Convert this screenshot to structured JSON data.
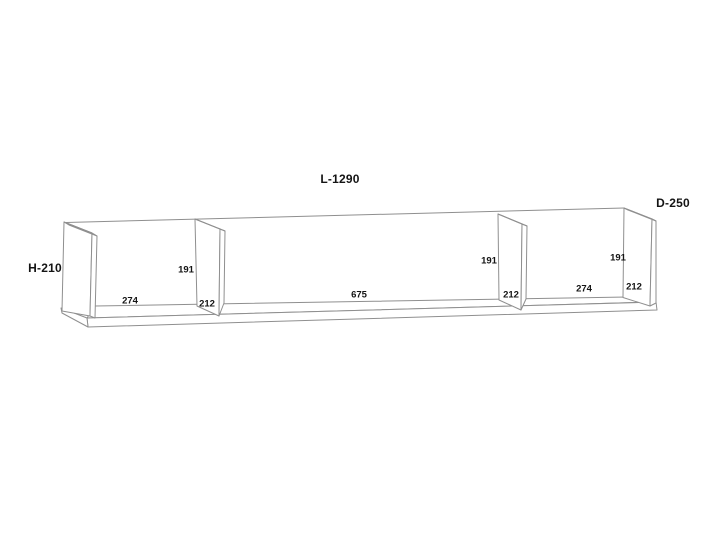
{
  "diagram": {
    "type": "furniture-dimension-drawing",
    "subject": "wall-shelf-3d-line-drawing",
    "background_color": "#ffffff",
    "line_color": "#8f8f8f",
    "text_color": "#141414",
    "overall": {
      "length_label": "L-1290",
      "depth_label": "D-250",
      "height_label": "H-210"
    },
    "sections": [
      {
        "name": "left-compartment",
        "width": "274",
        "height": "191",
        "depth": "212"
      },
      {
        "name": "middle-compartment",
        "width": "675",
        "height": "191",
        "depth": "212"
      },
      {
        "name": "right-compartment",
        "width": "274",
        "height": "191",
        "depth": "212"
      }
    ]
  }
}
